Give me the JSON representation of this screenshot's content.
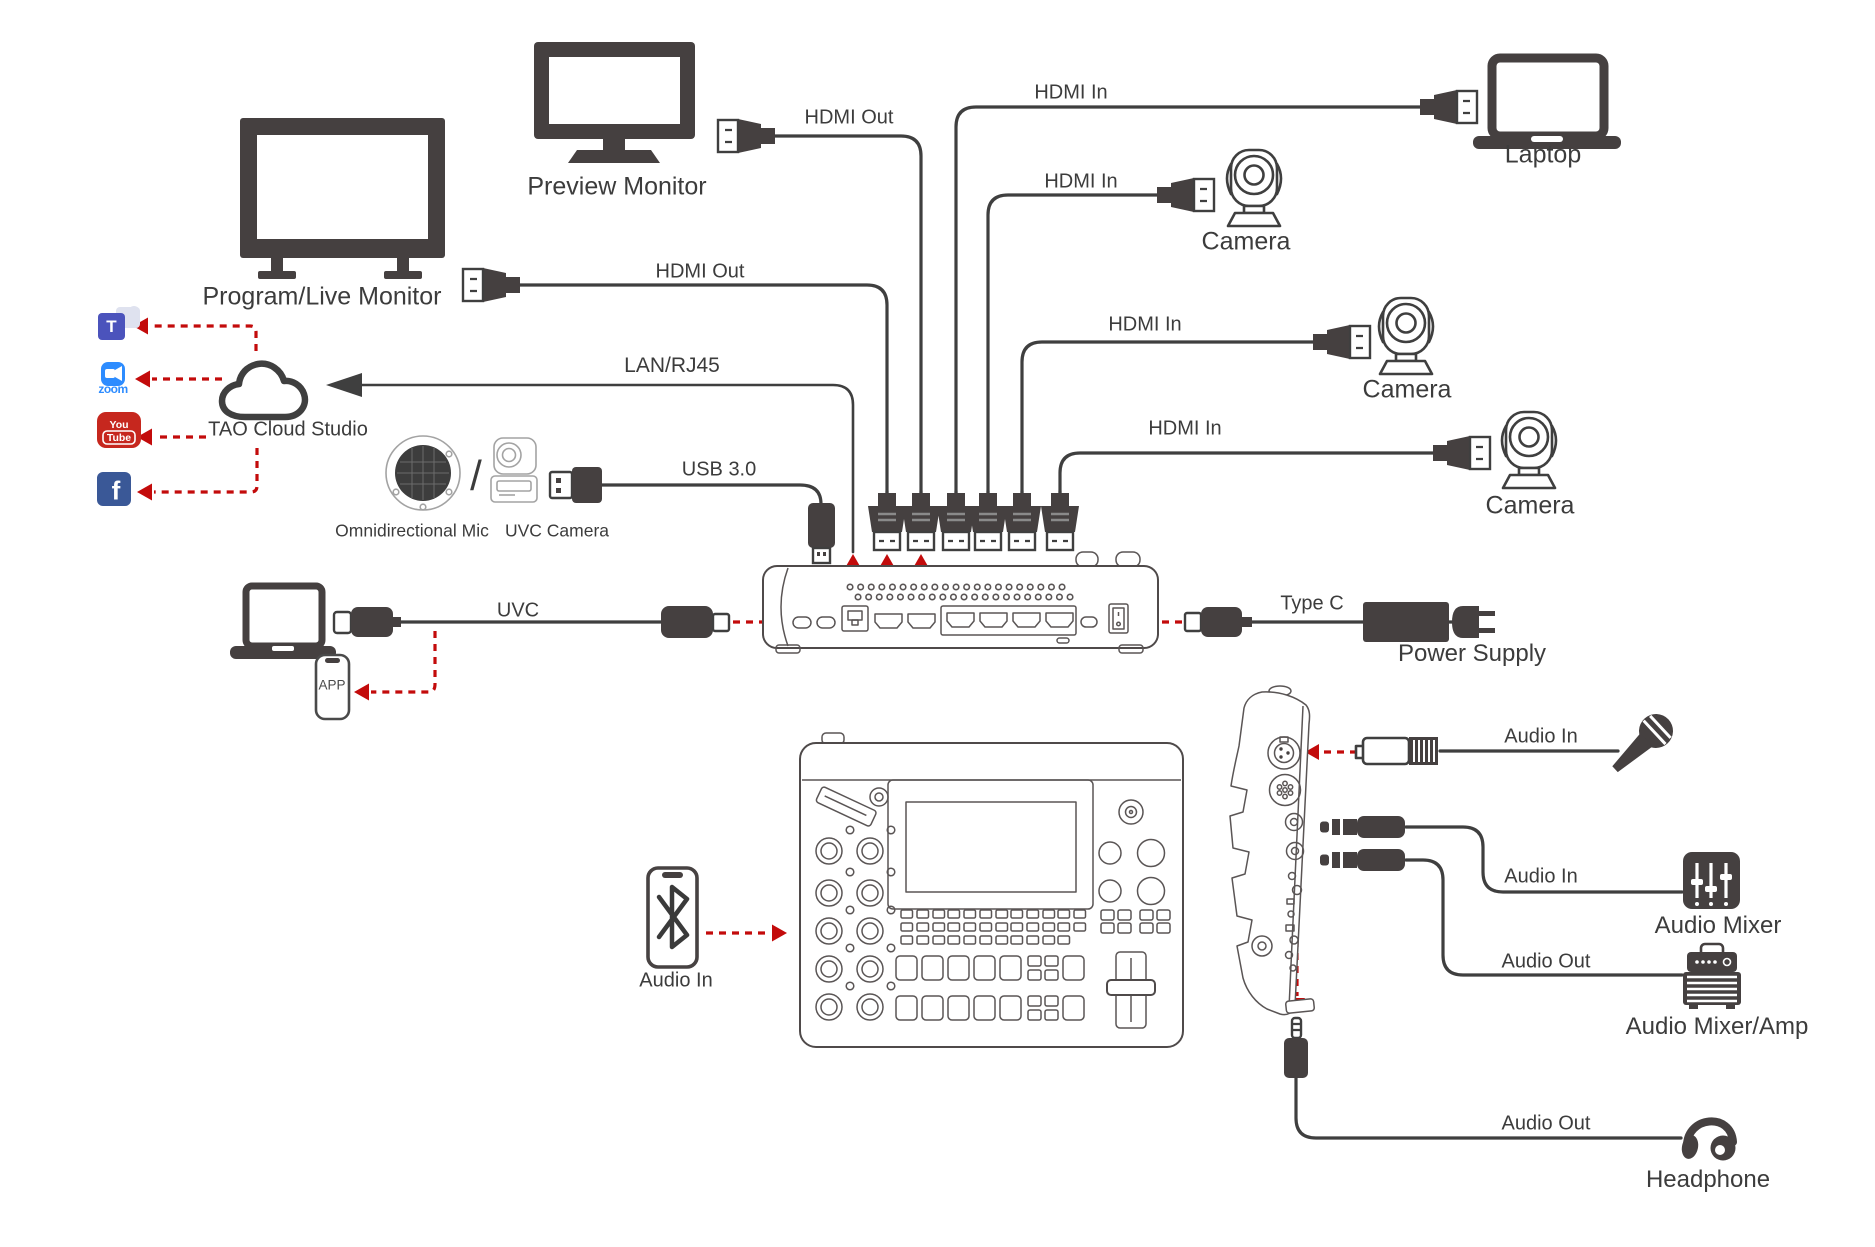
{
  "colors": {
    "line": "#3f3f3f",
    "ink": "#454040",
    "red": "#c30b0b",
    "text": "#3c3c3c",
    "teams": "#4b53bc",
    "teams_light": "#dfe2ef",
    "zoom": "#2d8cff",
    "youtube": "#c6271e",
    "facebook": "#3a5897",
    "light": "#a3a3a3"
  },
  "outputs": {
    "preview_monitor": {
      "label": "Preview Monitor",
      "connection": "HDMI Out"
    },
    "program_monitor": {
      "label": "Program/Live Monitor",
      "connection": "HDMI Out"
    }
  },
  "inputs": {
    "laptop": {
      "label": "Laptop",
      "connection": "HDMI In"
    },
    "camera1": {
      "label": "Camera",
      "connection": "HDMI In"
    },
    "camera2": {
      "label": "Camera",
      "connection": "HDMI In"
    },
    "camera3": {
      "label": "Camera",
      "connection": "HDMI In"
    }
  },
  "cloud": {
    "label": "TAO Cloud Studio",
    "connection": "LAN/RJ45",
    "platforms": {
      "teams_glyph": "T",
      "zoom_wordmark": "zoom",
      "youtube_line1": "You",
      "youtube_line2": "Tube",
      "facebook_glyph": "f"
    }
  },
  "usb_devices": {
    "omni_mic": "Omnidirectional Mic",
    "slash": "/",
    "uvc_camera": "UVC Camera",
    "connection": "USB 3.0"
  },
  "uvc_out": {
    "connection": "UVC",
    "phone_app": "APP"
  },
  "power": {
    "connection": "Type C",
    "label": "Power Supply"
  },
  "audio": {
    "bluetooth_in": "Audio In",
    "mic_in": "Audio In",
    "mixer_in": "Audio In",
    "mixer_label": "Audio Mixer",
    "amp_out": "Audio Out",
    "amp_label": "Audio Mixer/Amp",
    "headphone_out": "Audio Out",
    "headphone_label": "Headphone"
  }
}
